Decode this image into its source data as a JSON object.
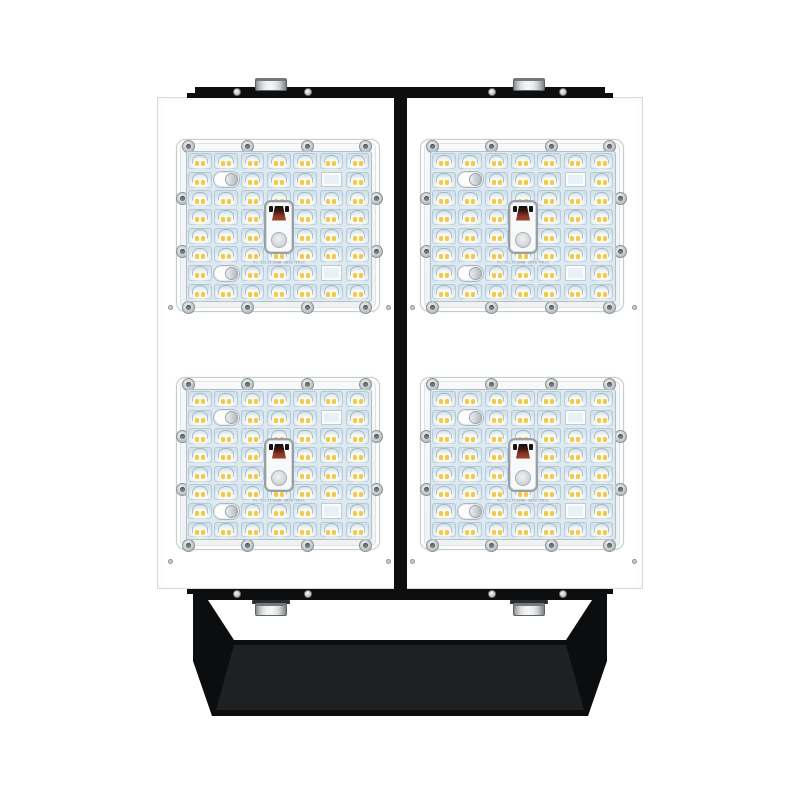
{
  "image": {
    "description": "Front view product render of a four-module industrial LED flood light with black top mounting rail and black U-shaped yoke bracket at the bottom",
    "background_color": "#ffffff"
  },
  "fixture": {
    "body_color": "#ffffff",
    "mount_color": "#0d0e0f",
    "metal_color": "#d9dbdc",
    "bracket_inner_face_color": "#1f2021",
    "module_count": 4,
    "bolt_count": 4,
    "rivet_count": 8,
    "modules": [
      {
        "id": "module-top-left"
      },
      {
        "id": "module-top-right"
      },
      {
        "id": "module-bottom-left"
      },
      {
        "id": "module-bottom-right"
      }
    ]
  },
  "module_config": {
    "rows": 8,
    "cols": 7,
    "leds_per_module": 52,
    "label": "PL-12Lx110WW-3030-5R1X",
    "colors": {
      "frame": "#f5f6f6",
      "plate": "#dde9f1",
      "cell": "#e9f2f7",
      "led": "#f2c84f",
      "screw": "#c9ced1",
      "connector_wire": "#8c3a28"
    },
    "specials": {
      "sensors": [
        [
          1,
          1
        ],
        [
          6,
          1
        ]
      ],
      "blank_squares": [
        [
          1,
          5
        ],
        [
          6,
          5
        ]
      ],
      "connector": {
        "col": 3,
        "row_span": "center"
      }
    },
    "screws_per_module": 12
  }
}
